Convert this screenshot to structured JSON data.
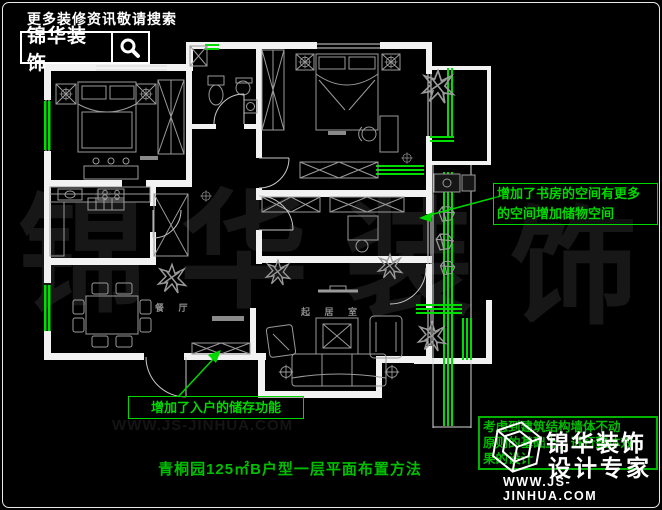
{
  "banner": {
    "slogan": "更多装修资讯敬请搜索",
    "brand": "锦华装饰"
  },
  "plan": {
    "labels": {
      "dining": "餐 厅",
      "living": "起 居 室"
    },
    "colors": {
      "wall": "#ffffff",
      "furniture": "#9a9a9a",
      "window_green": "#00dd00",
      "annotation_green": "#00d800",
      "title_green": "#00be00",
      "background": "#000000"
    }
  },
  "annotations": {
    "study_note_line1": "增加了书房的空间有更多",
    "study_note_line2": "的空间增加储物空间",
    "entry_note": "增加了入户的储存功能"
  },
  "title": "青桐园125㎡B户型一层平面布置方法",
  "footer": {
    "note_line1": "考虑到建筑结构墙体不动",
    "note_line2": "原则的基础上，进行整体效",
    "note_line3": "果的设计",
    "brand_line1": "锦华装饰",
    "brand_line2": "设计专家",
    "url": "WWW.JS-JINHUA.COM"
  },
  "watermark": {
    "chars": [
      "锦",
      "华",
      "装",
      "饰"
    ],
    "url_ghost": "WWW.JS-JINHUA.COM"
  }
}
